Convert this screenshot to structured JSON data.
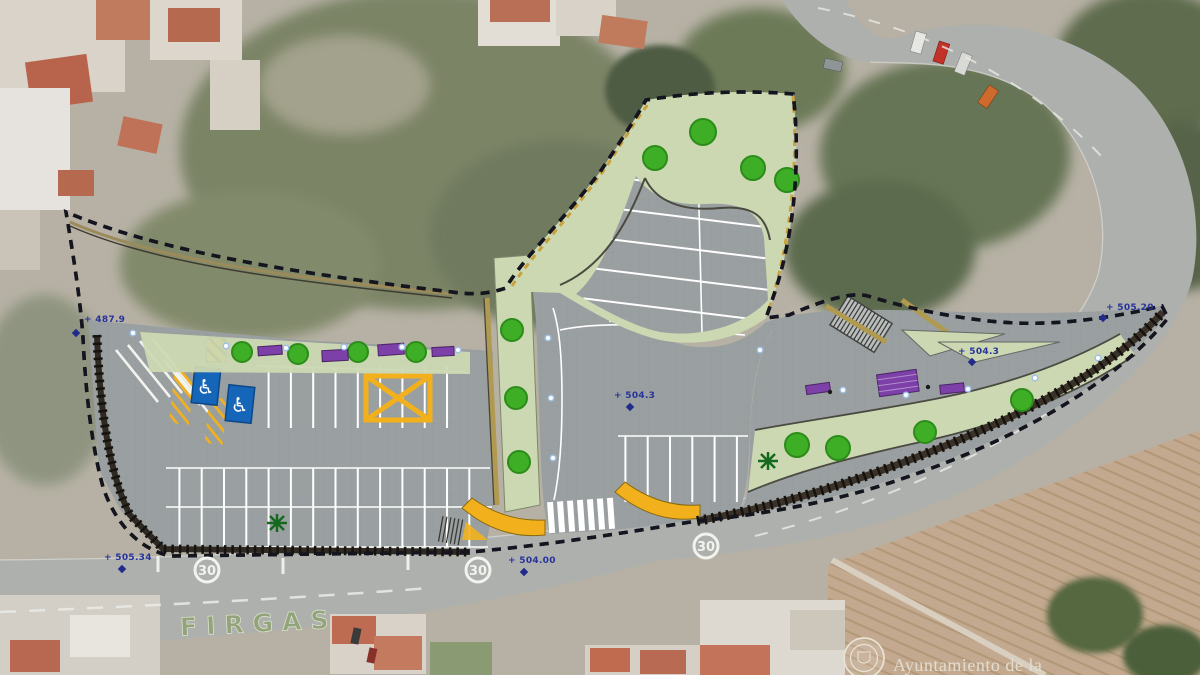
{
  "meta": {
    "description": "Aerial photo of Firgas with overlaid site plan for a new public parking and landscaped promenade"
  },
  "labels": {
    "elevations": [
      {
        "text": "+ 487.9"
      },
      {
        "text": "+ 505.34"
      },
      {
        "text": "+ 504.00"
      },
      {
        "text": "+ 504.3"
      },
      {
        "text": "+ 504.3"
      },
      {
        "text": "+ 505.20"
      }
    ],
    "speed_limit": "30",
    "road_place_name": "FIRGAS"
  },
  "footer": {
    "attribution": "Ayuntamiento de la"
  },
  "icons": {
    "accessible_parking": "♿"
  },
  "colors": {
    "boundary_blue": "#22307f",
    "pavement_gray": "#9aa0a1",
    "landscape_green": "#ccd8b2",
    "tree_green": "#3fae27",
    "furniture_purple": "#7d3fa8",
    "marking_yellow": "#f2b11c",
    "accessible_blue": "#1566b8",
    "road_gray": "#adb0ad",
    "farmland_brown": "#c3a98f"
  }
}
